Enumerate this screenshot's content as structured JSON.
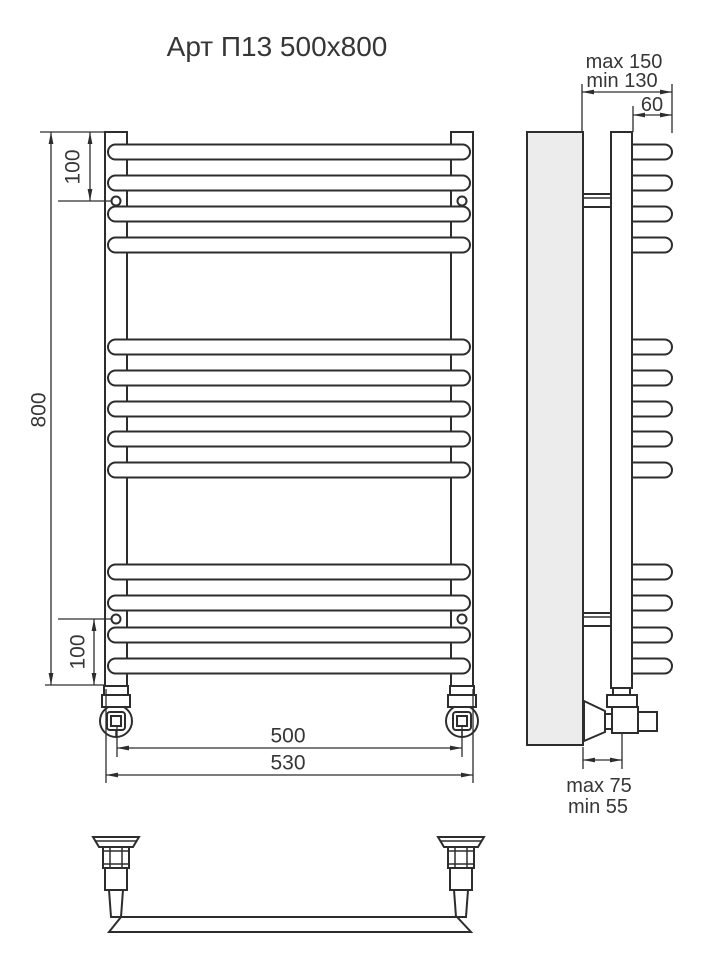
{
  "title": "Арт П13 500х800",
  "dimensions": {
    "height": "800",
    "top_offset": "100",
    "bottom_offset": "100",
    "width_connections": "500",
    "width_overall": "530",
    "depth_max": "max 150",
    "depth_min": "min 130",
    "bar_extension": "60",
    "valve_max": "max 75",
    "valve_min": "min 55"
  },
  "structure": {
    "bar_count": 13,
    "bar_groups": [
      4,
      5,
      4
    ],
    "mounting_holes": 4
  },
  "colors": {
    "line": "#2d2d2d",
    "wall_fill": "#ececec",
    "background": "#ffffff",
    "text": "#363636"
  }
}
